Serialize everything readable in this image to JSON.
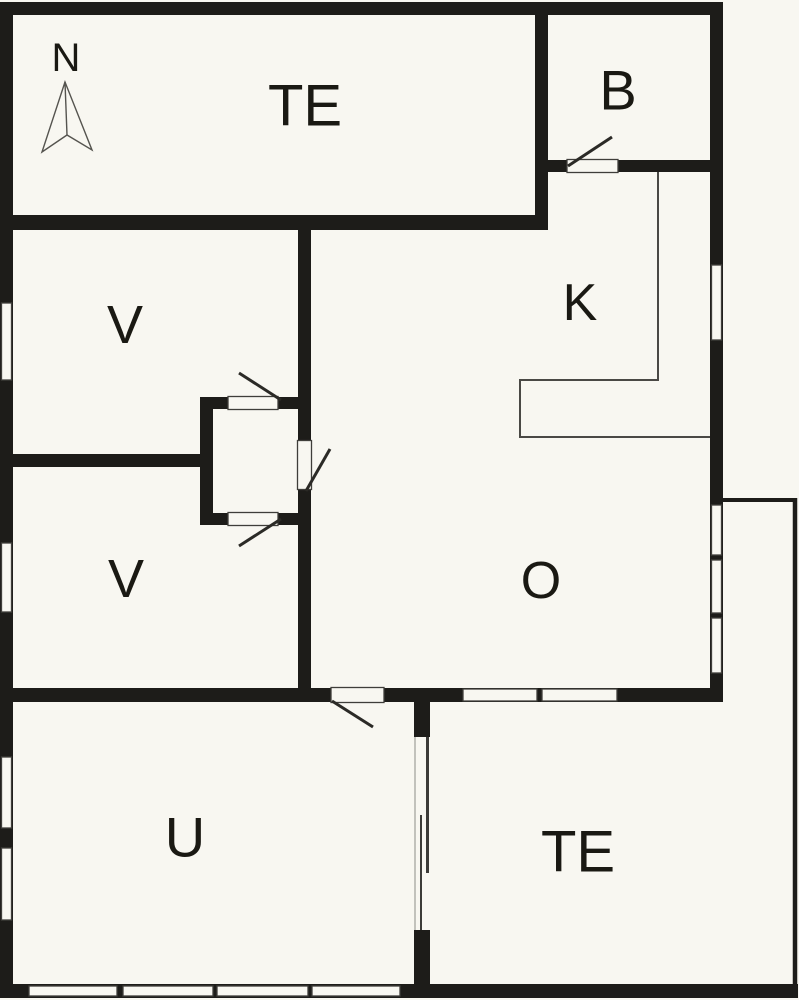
{
  "canvas": {
    "width": 799,
    "height": 1000
  },
  "colors": {
    "background": "#f8f7f1",
    "wall": "#1d1c19",
    "frame": "#3f3e3a",
    "fixture": "#4a4945",
    "door": "#2b2a26",
    "terrace": "#1d1c19",
    "slider": "#3c3b38",
    "edge": "#8d8c86",
    "text": "#1a1913",
    "arrow": "#55544f"
  },
  "labels": [
    {
      "name": "label-north-letter",
      "text": "N",
      "x": 66,
      "y": 58,
      "size": 40
    },
    {
      "name": "label-te-north",
      "text": "TE",
      "x": 305,
      "y": 106,
      "size": 58
    },
    {
      "name": "label-b",
      "text": "B",
      "x": 618,
      "y": 90,
      "size": 56
    },
    {
      "name": "label-k",
      "text": "K",
      "x": 580,
      "y": 303,
      "size": 52
    },
    {
      "name": "label-v-upper",
      "text": "V",
      "x": 125,
      "y": 325,
      "size": 54
    },
    {
      "name": "label-v-lower",
      "text": "V",
      "x": 126,
      "y": 579,
      "size": 54
    },
    {
      "name": "label-o",
      "text": "O",
      "x": 541,
      "y": 581,
      "size": 52
    },
    {
      "name": "label-u",
      "text": "U",
      "x": 185,
      "y": 837,
      "size": 56
    },
    {
      "name": "label-te-south",
      "text": "TE",
      "x": 578,
      "y": 852,
      "size": 58
    }
  ],
  "walls": [
    [
      0,
      2,
      723,
      13,
      "wall-north-outer"
    ],
    [
      0,
      2,
      13,
      996,
      "wall-west-outer"
    ],
    [
      0,
      984,
      798,
      14,
      "wall-south-outer"
    ],
    [
      710,
      2,
      13,
      501,
      "wall-east-upper"
    ],
    [
      710,
      503,
      13,
      199,
      "wall-east-living"
    ],
    [
      0,
      215,
      548,
      15,
      "wall-terrace-north-south"
    ],
    [
      535,
      2,
      13,
      228,
      "wall-bath-west"
    ],
    [
      535,
      160,
      33,
      12,
      "wall-bath-south-left"
    ],
    [
      618,
      160,
      104,
      12,
      "wall-bath-south-right"
    ],
    [
      13,
      688,
      710,
      14,
      "wall-mid-south"
    ],
    [
      0,
      454,
      202,
      13,
      "wall-rooms-divider"
    ],
    [
      200,
      397,
      13,
      128,
      "wall-vestibule-west"
    ],
    [
      200,
      397,
      98,
      12,
      "wall-vestibule-north"
    ],
    [
      200,
      513,
      98,
      12,
      "wall-vestibule-south"
    ],
    [
      298,
      230,
      13,
      458,
      "wall-hall-east"
    ],
    [
      414,
      688,
      16,
      310,
      "wall-u-te-divider"
    ]
  ],
  "openings": [
    [
      229,
      397,
      49,
      12,
      "opening-vestibule-north-door"
    ],
    [
      229,
      513,
      49,
      12,
      "opening-vestibule-south-door"
    ],
    [
      298,
      440,
      13,
      50,
      "opening-hall-door"
    ],
    [
      332,
      688,
      51,
      14,
      "opening-u-door"
    ],
    [
      414,
      737,
      16,
      193,
      "opening-sliding-door"
    ]
  ],
  "windows": [
    [
      1.5,
      303,
      10,
      77,
      "window-west-v-upper"
    ],
    [
      1.5,
      543,
      10,
      69,
      "window-west-v-lower"
    ],
    [
      1.5,
      757,
      10,
      71,
      "window-west-u-1"
    ],
    [
      1.5,
      848,
      10,
      72,
      "window-west-u-2"
    ],
    [
      711.5,
      265,
      10,
      75,
      "window-east-kitchen"
    ],
    [
      711.5,
      505,
      10,
      50,
      "window-east-living-1"
    ],
    [
      711.5,
      560,
      10,
      53,
      "window-east-living-2"
    ],
    [
      711.5,
      618,
      10,
      55,
      "window-east-living-3"
    ],
    [
      29,
      986,
      88,
      10,
      "window-south-u-1"
    ],
    [
      123,
      986,
      90,
      10,
      "window-south-u-2"
    ],
    [
      217,
      986,
      91,
      10,
      "window-south-u-3"
    ],
    [
      312,
      986,
      88,
      10,
      "window-south-u-4"
    ],
    [
      463,
      689,
      74,
      12,
      "window-living-terrace-1"
    ],
    [
      542,
      689,
      75,
      12,
      "window-living-terrace-2"
    ]
  ],
  "thresholds": [
    [
      567,
      159.5,
      51,
      13,
      "threshold-bath-door"
    ],
    [
      228,
      396.5,
      50,
      13,
      "threshold-vestibule-north-door"
    ],
    [
      228,
      512.5,
      50,
      13,
      "threshold-vestibule-south-door"
    ],
    [
      297.5,
      440.5,
      14,
      49,
      "threshold-hall-door"
    ],
    [
      331,
      687.5,
      53,
      15,
      "threshold-u-door"
    ]
  ],
  "door_leaves": [
    [
      568,
      166,
      612,
      137,
      3,
      "door-leaf-bath"
    ],
    [
      239,
      373,
      281,
      400,
      3,
      "door-leaf-vestibule-north"
    ],
    [
      239,
      546,
      281,
      519,
      3,
      "door-leaf-vestibule-south"
    ],
    [
      306,
      491,
      330,
      449,
      3,
      "door-leaf-hall"
    ],
    [
      332,
      701,
      373,
      727,
      3,
      "door-leaf-u"
    ]
  ],
  "terrace_edges": [
    [
      723,
      500,
      797,
      500,
      4,
      "terrace-edge-north"
    ],
    [
      795,
      498,
      795,
      998,
      4.5,
      "terrace-edge-east"
    ]
  ],
  "slider_lines": [
    [
      427.5,
      737,
      427.5,
      873,
      3,
      "sliding-door-panel-a"
    ],
    [
      421,
      815,
      421,
      930,
      2,
      "sliding-door-panel-b"
    ],
    [
      415,
      737,
      415,
      930,
      1,
      "sliding-door-track"
    ]
  ],
  "counter": {
    "points": "658,172 658,380 520,380 520,437 710,437",
    "width": 2
  },
  "north_arrow": {
    "polygon": "65,82 42,152 67,135 92,150",
    "line": [
      65,
      82,
      67,
      135
    ],
    "stroke_width": 1.4
  }
}
